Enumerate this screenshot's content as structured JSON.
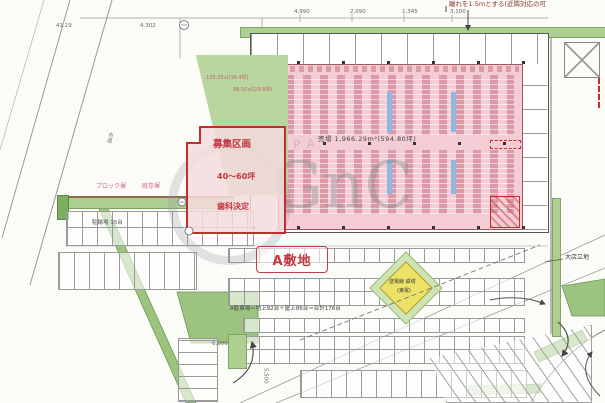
{
  "plan": {
    "note_top": "離れを1.5mとする(近隣対応の可",
    "sales_floor": "売場 1,966.29m²(594.80坪)",
    "tenant": {
      "line1": "募集区画",
      "line2": "40～60坪",
      "line3": "歯科決定"
    },
    "green_areas": {
      "a": "120.20㎡(36.4坪)",
      "b": "98.50㎡(29.8坪)"
    },
    "site": "A敷地",
    "tower": {
      "line1": "送電線 鉄塔",
      "line2": "(東電)"
    },
    "parking_total": "A駐車場＝地上92台＋屋上86台＝合計178台",
    "labels": {
      "block_wall": "ブロック塀",
      "existing_wall": "既存塀",
      "bicycle": "駐輪場 15台",
      "daiten": "大店立地",
      "road": "市道"
    },
    "dims": {
      "d1": "4,990",
      "d2": "2,090",
      "d3": "1,345",
      "d4": "3,100",
      "d5": "6,000",
      "d6": "5,500",
      "l1": "41.19",
      "l2": "4.302"
    },
    "watermark": {
      "main": "GnC",
      "diag": "OKTOPA"
    }
  }
}
